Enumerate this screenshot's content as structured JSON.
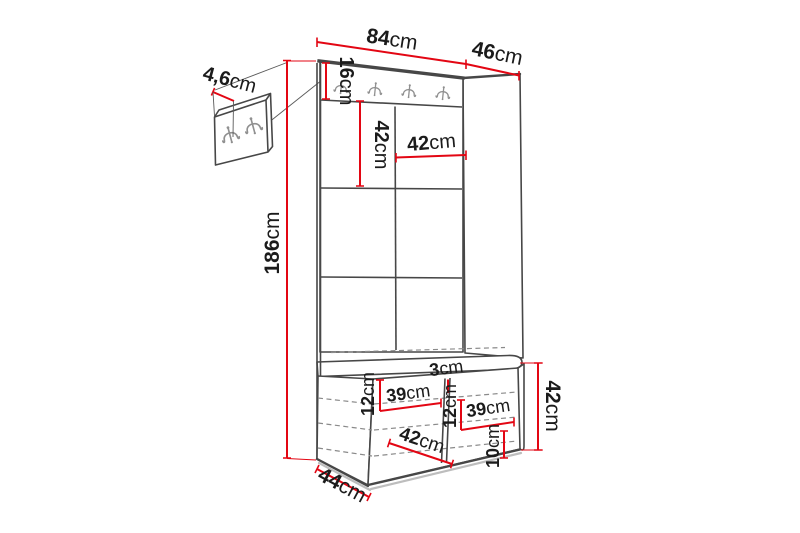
{
  "diagram": {
    "type": "furniture-dimension-diagram",
    "subject": "hallway unit with coat hook panel, upholstered wall panels and shoe bench",
    "unit_of_measure": "cm"
  },
  "dims": {
    "detail_thickness": {
      "value": "4,6",
      "unit": "cm"
    },
    "top_width": {
      "value": "84",
      "unit": "cm"
    },
    "top_depth": {
      "value": "46",
      "unit": "cm"
    },
    "hook_panel_height": {
      "value": "16",
      "unit": "cm"
    },
    "panel_tile_height": {
      "value": "42",
      "unit": "cm"
    },
    "panel_tile_width": {
      "value": "42",
      "unit": "cm"
    },
    "total_height": {
      "value": "186",
      "unit": "cm"
    },
    "bench_top_gap_left": {
      "value": "12",
      "unit": "cm"
    },
    "bench_shelf_width_left": {
      "value": "39",
      "unit": "cm"
    },
    "divider_thickness": {
      "value": "3",
      "unit": "cm"
    },
    "bench_mid_gap_right": {
      "value": "12",
      "unit": "cm"
    },
    "bench_shelf_width_right": {
      "value": "39",
      "unit": "cm"
    },
    "bench_bottom_gap": {
      "value": "10",
      "unit": "cm"
    },
    "bench_interior_width": {
      "value": "42",
      "unit": "cm"
    },
    "bench_height": {
      "value": "42",
      "unit": "cm"
    },
    "bench_depth": {
      "value": "44",
      "unit": "cm"
    }
  },
  "icons": {
    "coat_hook": "double-coat-hook"
  },
  "colors": {
    "dimension": "#e30613",
    "outline": "#474747",
    "hidden": "#8a8a8a",
    "hook": "#909090",
    "shadow": "#bdbdbd"
  }
}
